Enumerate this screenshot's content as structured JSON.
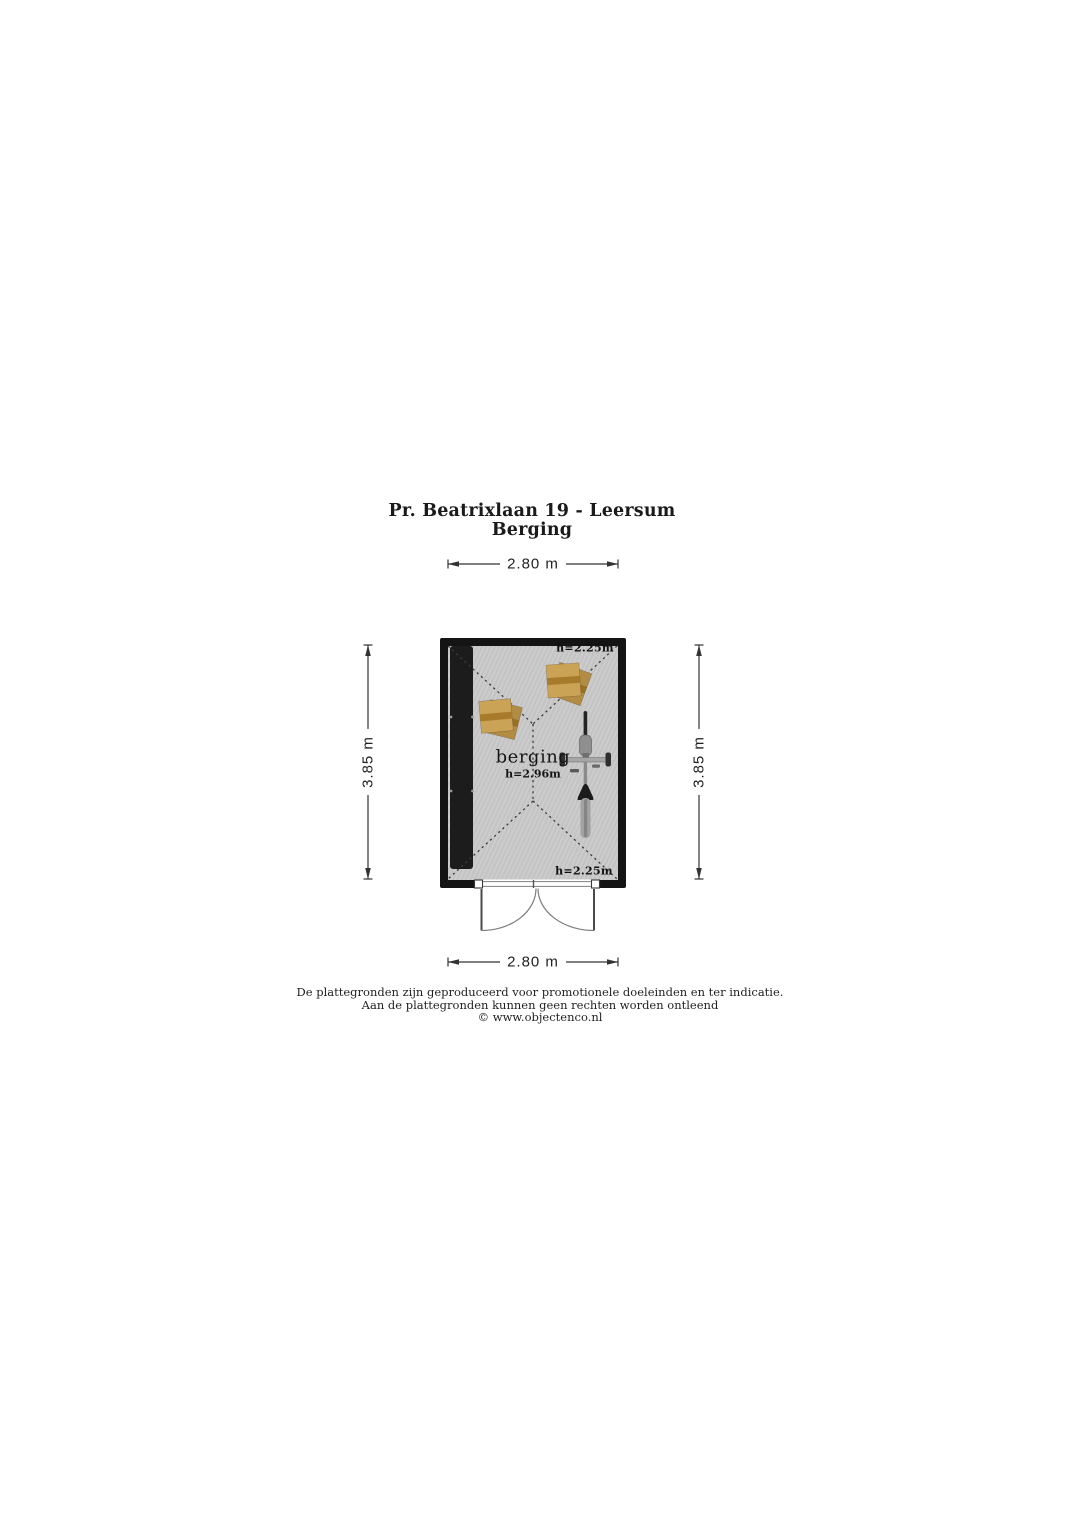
{
  "header": {
    "title": "Pr. Beatrixlaan 19 - Leersum",
    "subtitle": "Berging"
  },
  "dimensions": {
    "top": "2.80 m",
    "bottom": "2.80 m",
    "left": "3.85 m",
    "right": "3.85 m"
  },
  "room": {
    "name": "berging",
    "ridge_height": "h=2.96m",
    "eave_height_top": "h=2.25m",
    "eave_height_bottom": "h=2.25m"
  },
  "footer": {
    "line1": "De plattegronden zijn geproduceerd voor promotionele doeleinden en ter indicatie.",
    "line2": "Aan de plattegronden kunnen geen rechten worden ontleend",
    "line3": "© www.objectenco.nl"
  },
  "colors": {
    "wall": "#141414",
    "floor": "#c9c9c9",
    "cabinet": "#1c1c1c",
    "dotted_line": "#3c3c3c",
    "crate_front": "#caa357",
    "crate_front_stripe": "#a87b2b",
    "crate_back": "#b18c42",
    "crate_back_stripe": "#996f24",
    "door_line": "#4a4a4a"
  },
  "icons": {
    "crate": "crate-icon",
    "bicycle": "bicycle-icon",
    "cabinet": "storage-cabinet",
    "door": "double-swing-door-icon"
  }
}
